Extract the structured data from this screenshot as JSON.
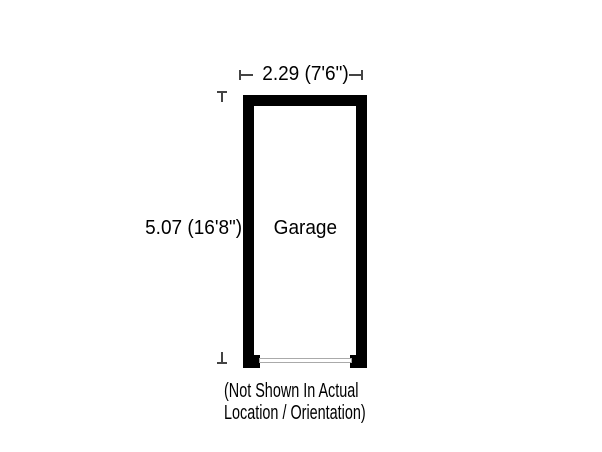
{
  "canvas": {
    "width_px": 602,
    "height_px": 452,
    "background": "#ffffff"
  },
  "floorplan": {
    "room_label": "Garage",
    "width_dimension": "2.29 (7'6\")",
    "height_dimension": "5.07 (16'8\")",
    "note_line1": "(Not Shown In Actual",
    "note_line2": "Location / Orientation)",
    "colors": {
      "wall": "#000000",
      "door_outline": "#aaaaaa",
      "text": "#000000",
      "dimension_tick": "#444444"
    },
    "icons": {
      "dim_tick_left": "dimension-end-tick-left",
      "dim_tick_right": "dimension-end-tick-right",
      "dim_tick_top": "dimension-end-tick-top",
      "dim_tick_bottom": "dimension-end-tick-bottom"
    }
  }
}
